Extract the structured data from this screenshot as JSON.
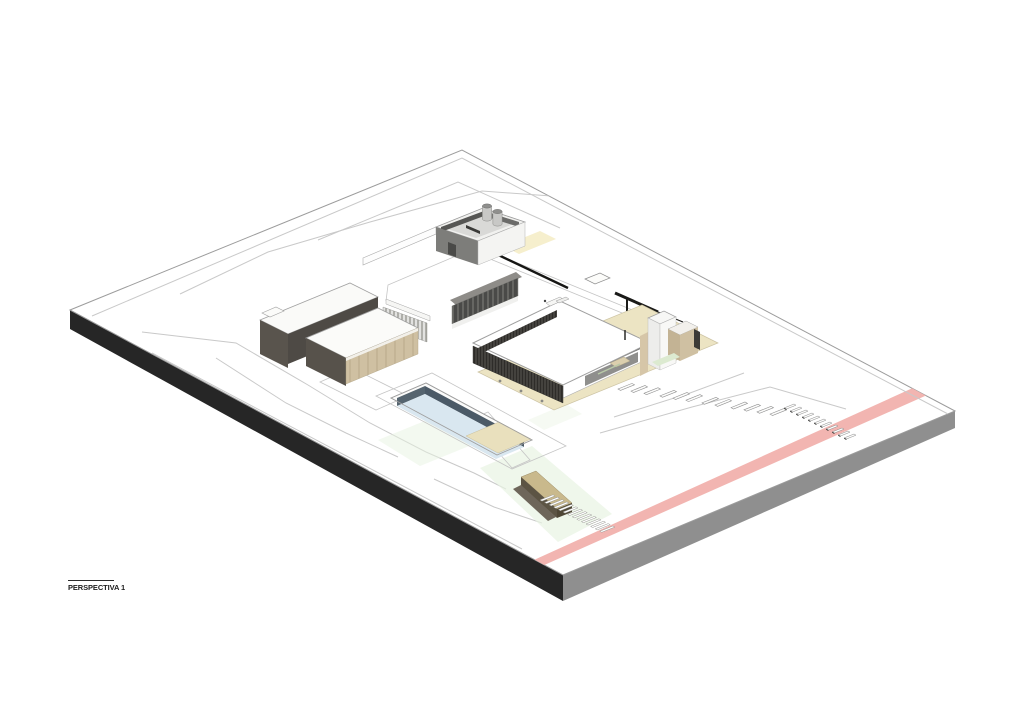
{
  "title_block": {
    "label": "PERSPECTIVA 1"
  },
  "colors": {
    "page_bg": "#ffffff",
    "plate_side_dark": "#262626",
    "plate_side_gray": "#8f8f8f",
    "road_pink": "#f2b5b1",
    "contour_line": "#c9c9c9",
    "wall_dark": "#57524b",
    "wall_tan": "#cfc0a2",
    "terrace_beige": "#ece4c3",
    "louver_dark": "#2e2c29",
    "glass_dark": "#4a4a48",
    "pool_wall": "#4b5a67",
    "pool_water": "#d9e7f0",
    "deck_beige": "#e9e0bd",
    "green_tint": "#e8f3e2",
    "stair_tan": "#c9b98c",
    "stair_dark": "#4f4736",
    "cream_patch": "#f6efcd"
  }
}
